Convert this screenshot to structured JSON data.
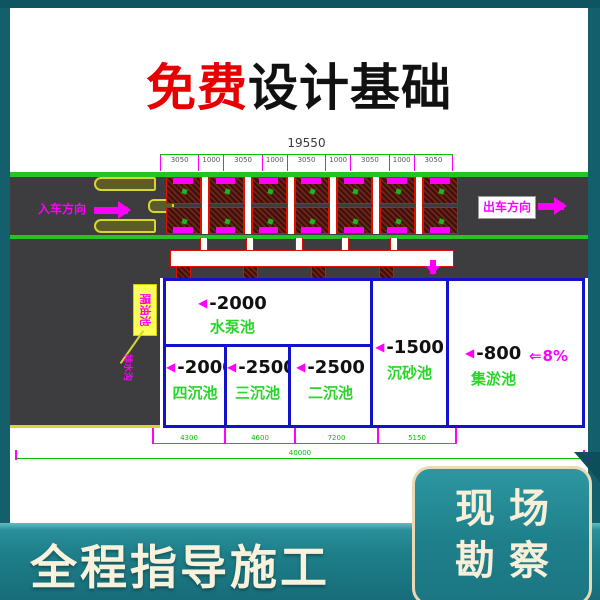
{
  "title": {
    "highlight": "免费",
    "rest": "设计基础"
  },
  "drawing": {
    "top_dim_total": "19550",
    "top_dim_segments": [
      "3050",
      "1000",
      "3050",
      "1000",
      "3050",
      "1000",
      "3050",
      "1000",
      "3050"
    ],
    "entry_label": "入车方向",
    "exit_label": "出车方向",
    "callout_label": "隔油池",
    "callout_small_label": "排水沟",
    "pools": [
      {
        "depth": "-2000",
        "name": "水泵池"
      },
      {
        "depth": "-2000",
        "name": "四沉池"
      },
      {
        "depth": "-2500",
        "name": "三沉池"
      },
      {
        "depth": "-2500",
        "name": "二沉池"
      },
      {
        "depth": "-1500",
        "name": "沉砂池"
      },
      {
        "depth": "-800",
        "name": "集淤池"
      }
    ],
    "slope_value": "8%",
    "bottom_dims": [
      "4300",
      "4600",
      "7200",
      "5150"
    ],
    "bottom_dim_total": "40000",
    "bays": {
      "columns": 7,
      "rows": 2
    }
  },
  "footer": {
    "slogan": "全程指导施工"
  },
  "site_badge": {
    "line1": "现场",
    "line2": "勘察"
  },
  "colors": {
    "background_teal": "#135f6b",
    "footer_teal": "#1d7e89",
    "title_red": "#e80000",
    "dimension_green": "#00c000",
    "lane_line_green": "#26c326",
    "cad_magenta": "#ff00ff",
    "pool_border_blue": "#1212cc",
    "road_gray": "#3d3d3f",
    "bay_red": "#e01000",
    "island_yellow": "#d6d62e",
    "badge_cream": "#f8efd8"
  }
}
